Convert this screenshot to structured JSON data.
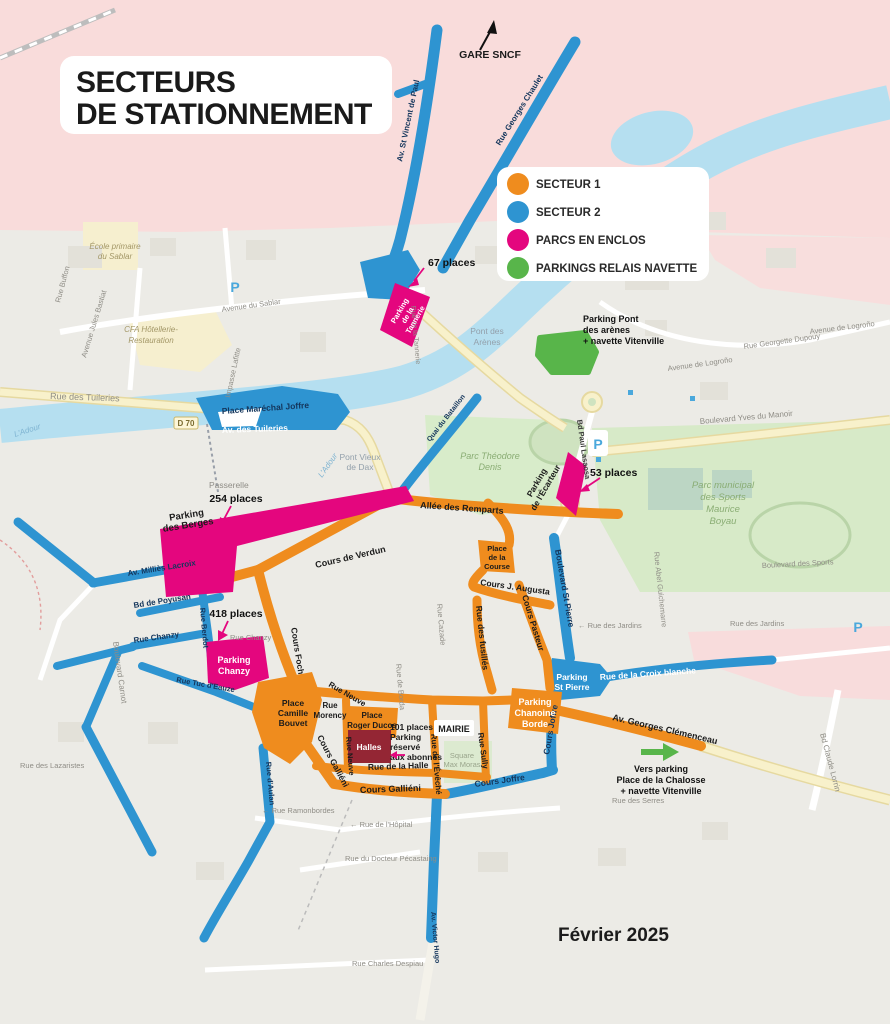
{
  "header": {
    "title_line1": "SECTEURS",
    "title_line2": "DE STATIONNEMENT"
  },
  "footer": {
    "date": "Février 2025"
  },
  "legend": {
    "secteur1": "SECTEUR 1",
    "secteur2": "SECTEUR 2",
    "parcs": "PARCS EN ENCLOS",
    "relais": "PARKINGS RELAIS NAVETTE"
  },
  "colors": {
    "secteur1_orange": "#EF8C1E",
    "secteur2_blue": "#2E94D1",
    "parcs_enclos_magenta": "#E4067E",
    "relais_green": "#58B54A",
    "halles_dark_red": "#942634",
    "river_blue": "#B5DFF0",
    "park_green": "#D8ECCA",
    "pink_zone": "#F9DCDB"
  },
  "annotations": {
    "gare": "GARE SNCF",
    "places_67": "67 places",
    "places_254": "254 places",
    "places_418": "418 places",
    "places_53": "53 places",
    "abonnes_1": "101 places",
    "abonnes_2": "Parking",
    "abonnes_3": "réservé",
    "abonnes_4": "aux abonnés",
    "pont_arenes_1": "Parking Pont",
    "pont_arenes_2": "des arènes",
    "pont_arenes_3": "+ navette Vitenville",
    "chalosse_1": "Vers parking",
    "chalosse_2": "Place de la Chalosse",
    "chalosse_3": "+ navette Vitenville",
    "mairie": "MAIRIE",
    "halles": "Halles",
    "d70": "D 70",
    "p_icon": "P"
  },
  "parkings": {
    "tannerie_1": "Parking",
    "tannerie_2": "de la",
    "tannerie_3": "Tannerie",
    "berges_1": "Parking",
    "berges_2": "des Berges",
    "chanzy_1": "Parking",
    "chanzy_2": "Chanzy",
    "ecarteur_1": "Parking",
    "ecarteur_2": "de l'Écarteur",
    "st_pierre_1": "Parking",
    "st_pierre_2": "St Pierre",
    "chanoine_1": "Parking",
    "chanoine_2": "Chanoine",
    "chanoine_3": "Borde"
  },
  "streets": {
    "allee_remparts": "Allée des Remparts",
    "cours_verdun": "Cours de Verdun",
    "cours_foch": "Cours Foch",
    "cours_j_augusta": "Cours J. Augusta",
    "cours_pasteur": "Cours Pasteur",
    "rue_fusilles": "Rue des fusillés",
    "bd_st_pierre": "Boulevard St Pierre",
    "place_course_1": "Place",
    "place_course_2": "de la",
    "place_course_3": "Course",
    "place_camille_1": "Place",
    "place_camille_2": "Camille",
    "place_camille_3": "Bouvet",
    "rue_morency_1": "Rue",
    "rue_morency_2": "Morency",
    "place_roger_1": "Place",
    "place_roger_2": "Roger Ducos",
    "rue_neuve_a": "Rue Neuve",
    "rue_neuve_b": "Rue Neuve",
    "rue_eveche": "Rue de l'Évêché",
    "rue_sully": "Rue Sully",
    "rue_halle": "Rue de la Halle",
    "cours_gallieni_a": "Cours Galliéni",
    "cours_gallieni_b": "Cours Galliéni",
    "cours_joffre_a": "Cours Joffre",
    "cours_joffre_b": "Cours Joffre",
    "av_clemenceau": "Av. Georges Clémenceau",
    "croix_blanche": "Rue de la Croix blanche",
    "av_millies": "Av. Milliès Lacroix",
    "bd_poyusan": "Bd de Poyusan",
    "rue_chanzy_b": "Rue Chanzy",
    "rue_berdot": "Rue Berdot",
    "rue_tuc": "Rue Tuc d'Eauze",
    "rue_aulan": "Rue d'Aulan",
    "av_victor_hugo": "Av. Victor Hugo",
    "av_st_vincent": "Av. St Vincent de Paul",
    "rue_chaulet": "Rue Georges Chaulet",
    "av_tuileries": "Av. des Tuileries",
    "place_joffre": "Place Maréchal Joffre",
    "quai": "Quai du Bataillon",
    "bd_lasaosa": "Bd Paul Lasaosa"
  },
  "bg_labels": {
    "rue_tuileries": "Rue des Tuileries",
    "passerelle": "Passerelle",
    "pont_vieux_1": "Pont Vieux",
    "pont_vieux_2": "de Dax",
    "pont_arenes_1": "Pont des",
    "pont_arenes_2": "Arènes",
    "ecole_1": "École primaire",
    "ecole_2": "du Sablar",
    "cfa_1": "CFA Hôtellerie-",
    "cfa_2": "Restauration",
    "av_sablar": "Avenue du Sablar",
    "rue_buffon": "Rue Buffon",
    "av_bastiat": "Avenue Jules Bastiat",
    "impasse_lafitte": "Impasse Lafitte",
    "av_logrono_1": "Avenue de Logroño",
    "av_logrono_2": "Avenue de Logroño",
    "rue_dupouy": "Rue Georgette Dupouy",
    "bd_yves": "Boulevard Yves du Manoir",
    "parc_theodore_1": "Parc Théodore",
    "parc_theodore_2": "Denis",
    "parc_sports_1": "Parc municipal",
    "parc_sports_2": "des Sports",
    "parc_sports_3": "Maurice",
    "parc_sports_4": "Boyau",
    "rue_jardins_1": "← Rue des Jardins",
    "rue_jardins_2": "Rue des Jardins",
    "rue_cazade": "Rue Cazade",
    "rue_abel": "Rue Abel Guichemarre",
    "bd_sports": "Boulevard des Sports",
    "rue_chanzy_g": "Rue Chanzy",
    "bd_carnot": "Boulevard Carnot",
    "rue_lazaristes": "Rue des Lazaristes",
    "rue_serres": "Rue des Serres",
    "square_1": "Square",
    "square_2": "Max Moras",
    "rue_borda": "Rue de Borda",
    "rue_tannerie": "Rue de la Tannerie",
    "rue_ramonbordes": "← Rue Ramonbordes",
    "rue_hopital": "← Rue de l'Hôpital",
    "rue_pecastaing": "Rue du Docteur Pécastaing",
    "rue_despiau": "Rue Charles Despiau",
    "bd_claude": "Bd Claude Lorrin",
    "adour_a": "L'Adour",
    "adour_b": "L'Adour"
  }
}
